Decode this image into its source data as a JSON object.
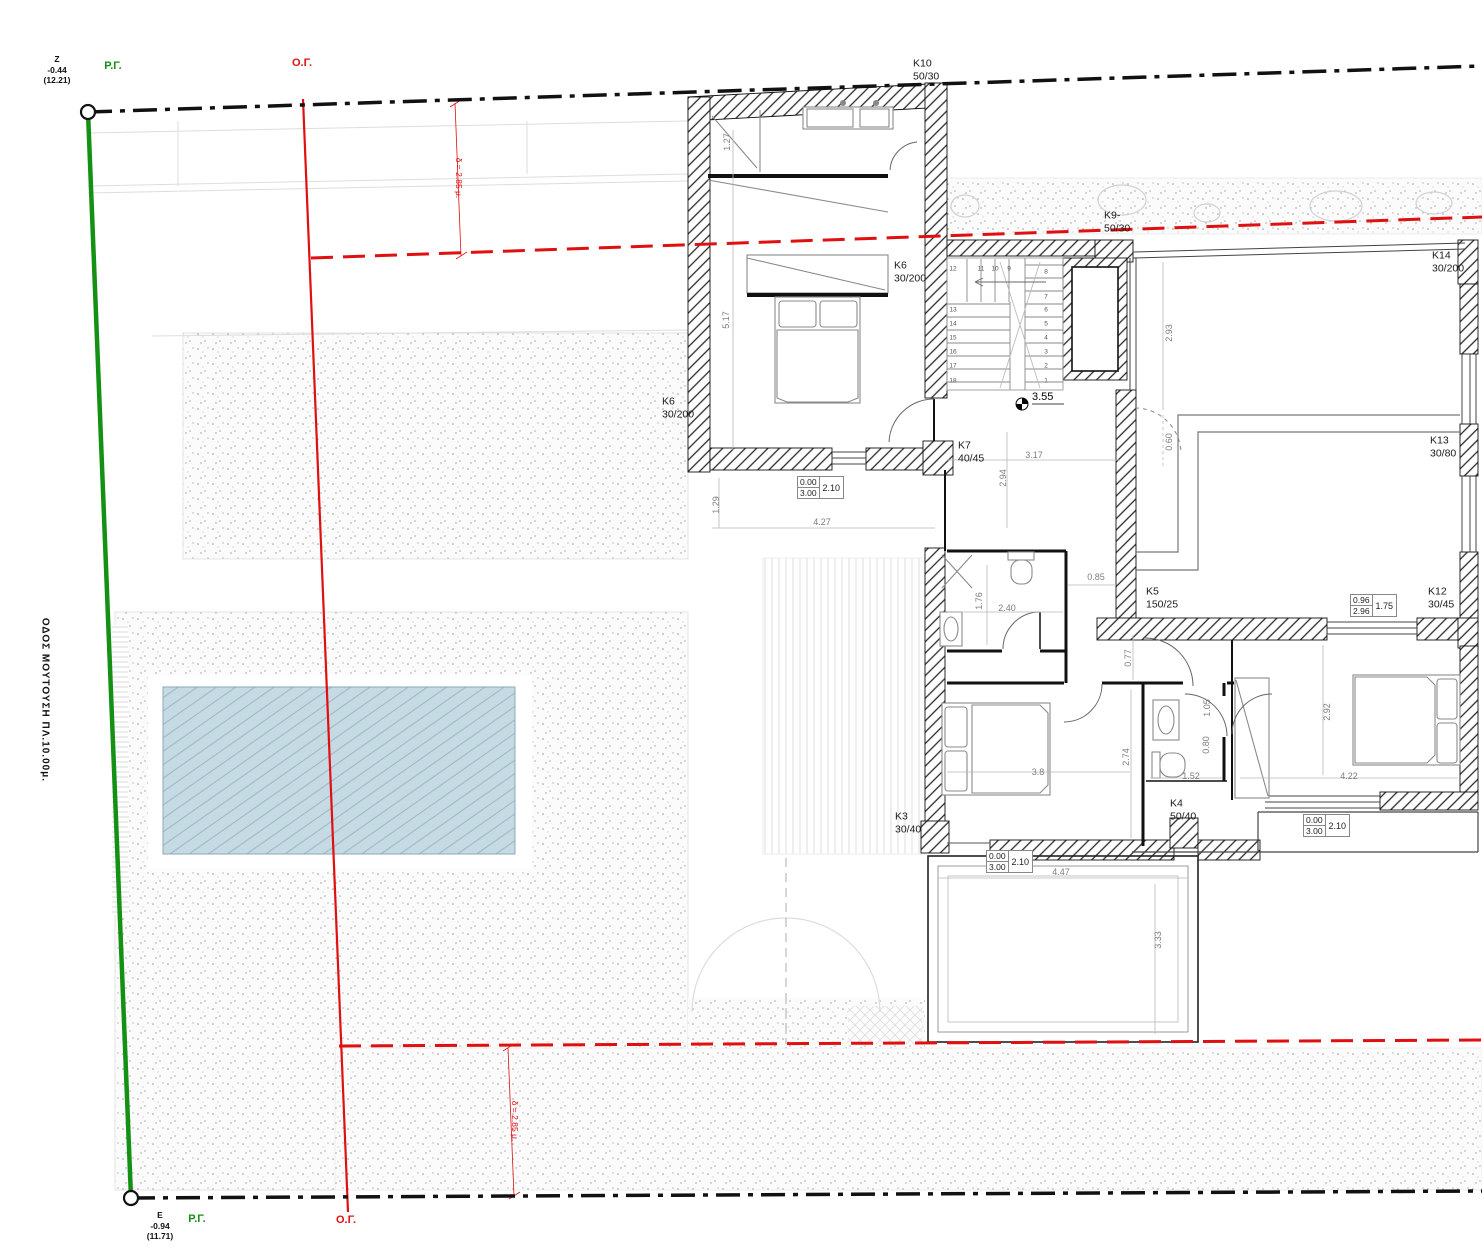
{
  "site": {
    "street_label": "ΟΔΟΣ ΜΟΥΤΟΥΣΗ ΠΛ.10.00μ.",
    "rg_label": "Ρ.Γ.",
    "og_label": "Ο.Γ.",
    "setback_note": "δ = 2.85 μ.",
    "bench_top": "Z\n-0.44\n(12.21)",
    "bench_bottom": "E\n-0.94\n(11.71)"
  },
  "plan": {
    "level_value": "3.55",
    "columns": [
      {
        "id": "K10",
        "size": "50/30",
        "x": 913,
        "y": 70
      },
      {
        "id": "K9-",
        "size": "50/30",
        "x": 1104,
        "y": 222
      },
      {
        "id": "K6",
        "size": "30/200",
        "x": 894,
        "y": 272
      },
      {
        "id": "K14",
        "size": "30/200",
        "x": 1432,
        "y": 262
      },
      {
        "id": "K13",
        "size": "30/80",
        "x": 1430,
        "y": 447
      },
      {
        "id": "K6",
        "size": "30/200",
        "x": 662,
        "y": 408
      },
      {
        "id": "K7",
        "size": "40/45",
        "x": 958,
        "y": 452
      },
      {
        "id": "K5",
        "size": "150/25",
        "x": 1146,
        "y": 598
      },
      {
        "id": "K12",
        "size": "30/45",
        "x": 1428,
        "y": 598
      },
      {
        "id": "K3",
        "size": "30/40",
        "x": 895,
        "y": 823
      },
      {
        "id": "K4",
        "size": "50/40",
        "x": 1170,
        "y": 810
      }
    ],
    "dimensions": [
      {
        "v": "1.27",
        "x": 727,
        "y": 142,
        "r": 1
      },
      {
        "v": "5.17",
        "x": 726,
        "y": 320,
        "r": 1
      },
      {
        "v": "1.29",
        "x": 716,
        "y": 505,
        "r": 1
      },
      {
        "v": "4.27",
        "x": 822,
        "y": 522
      },
      {
        "v": "3.17",
        "x": 1034,
        "y": 455
      },
      {
        "v": "2.94",
        "x": 1003,
        "y": 478,
        "r": 1
      },
      {
        "v": "2.93",
        "x": 1169,
        "y": 333,
        "r": 1
      },
      {
        "v": "0.60",
        "x": 1169,
        "y": 442,
        "r": 1
      },
      {
        "v": "0.85",
        "x": 1096,
        "y": 577
      },
      {
        "v": "1.76",
        "x": 979,
        "y": 601,
        "r": 1
      },
      {
        "v": "2.40",
        "x": 1007,
        "y": 608
      },
      {
        "v": "0.77",
        "x": 1128,
        "y": 658,
        "r": 1
      },
      {
        "v": "2.74",
        "x": 1126,
        "y": 757,
        "r": 1
      },
      {
        "v": "3.8",
        "x": 1038,
        "y": 772
      },
      {
        "v": "1.52",
        "x": 1191,
        "y": 776
      },
      {
        "v": "1.05",
        "x": 1207,
        "y": 708,
        "r": 1
      },
      {
        "v": "0.80",
        "x": 1206,
        "y": 745,
        "r": 1
      },
      {
        "v": "2.92",
        "x": 1327,
        "y": 712,
        "r": 1
      },
      {
        "v": "4.22",
        "x": 1349,
        "y": 776
      },
      {
        "v": "4.47",
        "x": 1061,
        "y": 872
      },
      {
        "v": "3.33",
        "x": 1158,
        "y": 940,
        "r": 1
      }
    ],
    "opening_boxes": [
      {
        "a": "0.00",
        "b": "3.00",
        "c": "2.10",
        "x": 797,
        "y": 476
      },
      {
        "a": "0.00",
        "b": "3.00",
        "c": "2.10",
        "x": 986,
        "y": 850
      },
      {
        "a": "0.00",
        "b": "3.00",
        "c": "2.10",
        "x": 1303,
        "y": 814
      },
      {
        "a": "0.96",
        "b": "2.96",
        "c": "1.75",
        "x": 1350,
        "y": 594
      }
    ],
    "stair_steps": [
      {
        "n": "12",
        "x": 953,
        "y": 269
      },
      {
        "n": "11",
        "x": 981,
        "y": 269
      },
      {
        "n": "10",
        "x": 995,
        "y": 269
      },
      {
        "n": "9",
        "x": 1009,
        "y": 269
      },
      {
        "n": "13",
        "x": 953,
        "y": 310
      },
      {
        "n": "14",
        "x": 953,
        "y": 324
      },
      {
        "n": "15",
        "x": 953,
        "y": 338
      },
      {
        "n": "16",
        "x": 953,
        "y": 352
      },
      {
        "n": "17",
        "x": 953,
        "y": 366
      },
      {
        "n": "18",
        "x": 953,
        "y": 381
      },
      {
        "n": "8",
        "x": 1046,
        "y": 272
      },
      {
        "n": "7",
        "x": 1046,
        "y": 297
      },
      {
        "n": "6",
        "x": 1046,
        "y": 310
      },
      {
        "n": "5",
        "x": 1046,
        "y": 324
      },
      {
        "n": "4",
        "x": 1046,
        "y": 338
      },
      {
        "n": "3",
        "x": 1046,
        "y": 352
      },
      {
        "n": "2",
        "x": 1046,
        "y": 366
      },
      {
        "n": "1",
        "x": 1046,
        "y": 381
      }
    ]
  },
  "colors": {
    "boundary_green": "#149114",
    "regulation_red": "#e01010",
    "pool_fill": "#c6dae4",
    "pool_line": "#9db9c8",
    "wall_hatch": "#2a2a2a"
  }
}
